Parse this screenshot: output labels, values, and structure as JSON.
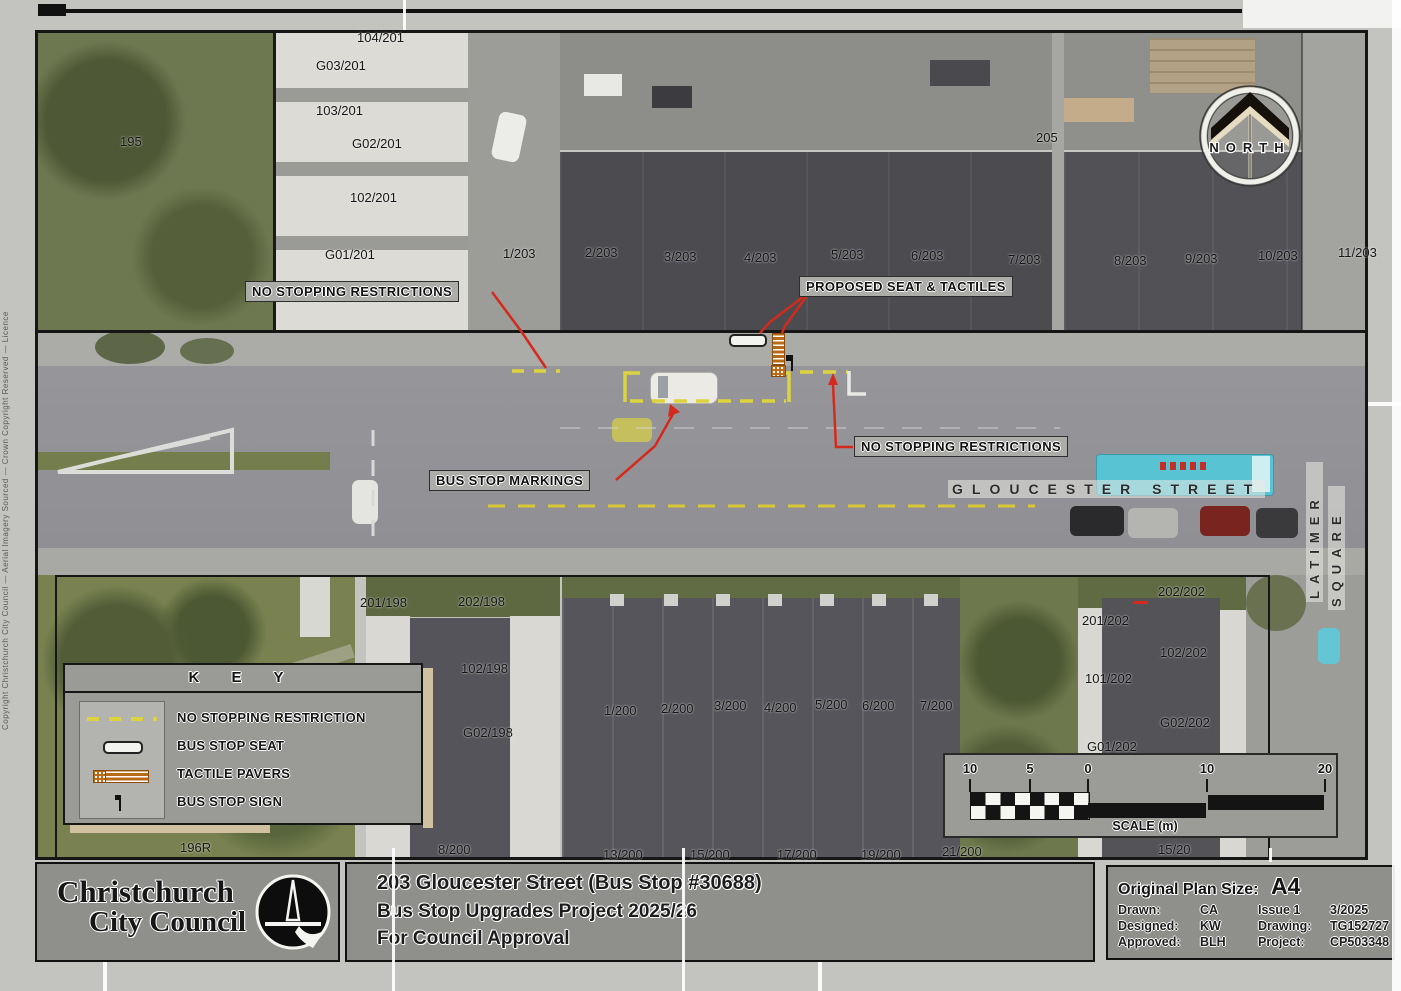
{
  "map": {
    "street_name": "GLOUCESTER STREET",
    "square_name_line1": "LATIMER",
    "square_name_line2": "SQUARE",
    "north_label": "NORTH",
    "lots": [
      {
        "t": "195",
        "x": 120,
        "y": 134
      },
      {
        "t": "104/201",
        "x": 357,
        "y": 30
      },
      {
        "t": "G03/201",
        "x": 316,
        "y": 58
      },
      {
        "t": "103/201",
        "x": 316,
        "y": 103
      },
      {
        "t": "G02/201",
        "x": 352,
        "y": 136
      },
      {
        "t": "102/201",
        "x": 350,
        "y": 190
      },
      {
        "t": "G01/201",
        "x": 325,
        "y": 247
      },
      {
        "t": "1/203",
        "x": 503,
        "y": 246
      },
      {
        "t": "2/203",
        "x": 585,
        "y": 245
      },
      {
        "t": "3/203",
        "x": 664,
        "y": 249
      },
      {
        "t": "4/203",
        "x": 744,
        "y": 250
      },
      {
        "t": "5/203",
        "x": 831,
        "y": 247
      },
      {
        "t": "6/203",
        "x": 911,
        "y": 248
      },
      {
        "t": "7/203",
        "x": 1008,
        "y": 252
      },
      {
        "t": "8/203",
        "x": 1114,
        "y": 253
      },
      {
        "t": "9/203",
        "x": 1185,
        "y": 251
      },
      {
        "t": "10/203",
        "x": 1258,
        "y": 248
      },
      {
        "t": "11/203",
        "x": 1338,
        "y": 245
      },
      {
        "t": "205",
        "x": 1036,
        "y": 130
      },
      {
        "t": "201/198",
        "x": 360,
        "y": 595
      },
      {
        "t": "202/198",
        "x": 458,
        "y": 594
      },
      {
        "t": "101/198",
        "x": 363,
        "y": 662
      },
      {
        "t": "102/198",
        "x": 461,
        "y": 661
      },
      {
        "t": "G02/198",
        "x": 463,
        "y": 725
      },
      {
        "t": "1/200",
        "x": 604,
        "y": 703
      },
      {
        "t": "2/200",
        "x": 661,
        "y": 701
      },
      {
        "t": "3/200",
        "x": 714,
        "y": 698
      },
      {
        "t": "4/200",
        "x": 764,
        "y": 700
      },
      {
        "t": "5/200",
        "x": 815,
        "y": 697
      },
      {
        "t": "6/200",
        "x": 862,
        "y": 698
      },
      {
        "t": "7/200",
        "x": 920,
        "y": 698
      },
      {
        "t": "202/202",
        "x": 1158,
        "y": 584
      },
      {
        "t": "201/202",
        "x": 1082,
        "y": 613
      },
      {
        "t": "102/202",
        "x": 1160,
        "y": 645
      },
      {
        "t": "101/202",
        "x": 1085,
        "y": 671
      },
      {
        "t": "G02/202",
        "x": 1160,
        "y": 715
      },
      {
        "t": "G01/202",
        "x": 1087,
        "y": 739
      },
      {
        "t": "196R",
        "x": 180,
        "y": 840
      },
      {
        "t": "8/200",
        "x": 438,
        "y": 842
      },
      {
        "t": "13/200",
        "x": 603,
        "y": 847
      },
      {
        "t": "15/200",
        "x": 690,
        "y": 847
      },
      {
        "t": "17/200",
        "x": 777,
        "y": 847
      },
      {
        "t": "19/200",
        "x": 861,
        "y": 847
      },
      {
        "t": "21/200",
        "x": 942,
        "y": 844
      },
      {
        "t": "15/20",
        "x": 1158,
        "y": 842
      }
    ]
  },
  "callouts": {
    "no_stopping_1": "NO STOPPING RESTRICTIONS",
    "proposed_seat": "PROPOSED SEAT & TACTILES",
    "no_stopping_2": "NO STOPPING RESTRICTIONS",
    "bus_stop_markings": "BUS STOP MARKINGS"
  },
  "key": {
    "title": "K E Y",
    "items": [
      {
        "label": "NO STOPPING RESTRICTION",
        "symbol": "yellow-dashed-line"
      },
      {
        "label": "BUS STOP SEAT",
        "symbol": "seat-outline"
      },
      {
        "label": "TACTILE PAVERS",
        "symbol": "tactile-pavers"
      },
      {
        "label": "BUS STOP SIGN",
        "symbol": "bus-stop-sign"
      }
    ]
  },
  "scale_bar": {
    "ticks": [
      "10",
      "5",
      "0",
      "10",
      "20"
    ],
    "caption": "SCALE (m)"
  },
  "title_block": {
    "line1": "203 Gloucester Street (Bus Stop #30688)",
    "line2": "Bus Stop Upgrades Project 2025/26",
    "line3": "For Council Approval"
  },
  "logo": {
    "line1": "Christchurch",
    "line2": "City Council"
  },
  "info_block": {
    "plan_size_label": "Original Plan Size:",
    "plan_size_value": "A4",
    "rows": [
      {
        "l1": "Drawn:",
        "v1": "CA",
        "l2": "Issue 1",
        "v2": "3/2025"
      },
      {
        "l1": "Designed:",
        "v1": "KW",
        "l2": "Drawing:",
        "v2": "TG152727"
      },
      {
        "l1": "Approved:",
        "v1": "BLH",
        "l2": "Project:",
        "v2": "CP503348"
      }
    ]
  },
  "side_note": "Copyright Christchurch City Council — Aerial Imagery Sourced — Crown Copyright Reserved — Licence",
  "colors": {
    "no-stopping-yellow": "#ddd33e",
    "centerline-yellow": "#d9c738",
    "leader-red": "#d42a1e",
    "tactile-orange": "#b96a16",
    "truck-cyan": "#57c3d3",
    "panel-gray": "#8f8f8c"
  }
}
